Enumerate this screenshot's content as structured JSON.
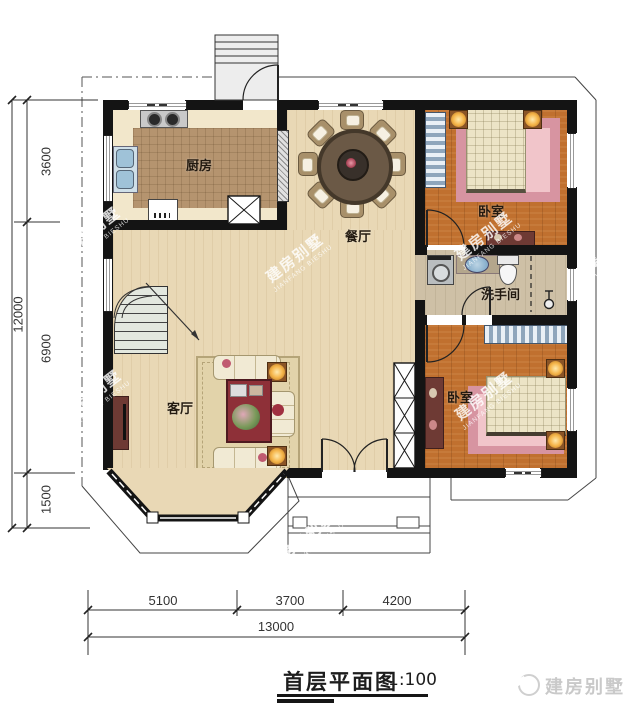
{
  "title": {
    "name": "首层平面图",
    "scale": "1:100"
  },
  "logo": {
    "text": "建房别墅"
  },
  "watermark": {
    "cn": "建房别墅",
    "en": "JIANFANG BIESHU"
  },
  "rooms": {
    "kitchen": "厨房",
    "dining": "餐厅",
    "living": "客厅",
    "bedroom_top": "卧室",
    "bedroom_bottom": "卧室",
    "bathroom": "洗手间"
  },
  "dimensions": {
    "left_top": "3600",
    "left_middle": "6900",
    "left_bottom": "1500",
    "left_total": "12000",
    "bottom_left": "5100",
    "bottom_middle": "3700",
    "bottom_right": "4200",
    "bottom_total": "13000"
  }
}
